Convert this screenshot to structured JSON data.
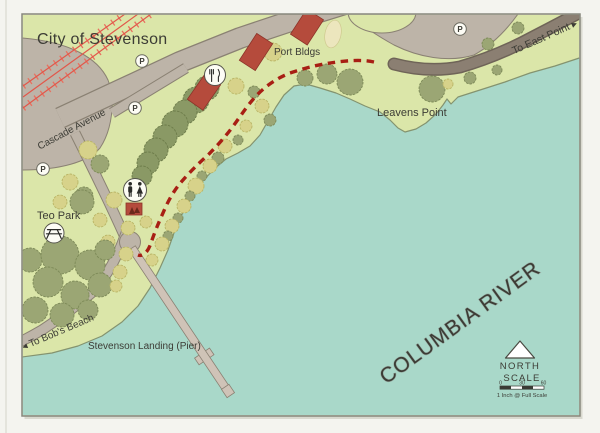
{
  "map_title": "City of Stevenson",
  "labels": {
    "port_bldgs": "Port Bldgs",
    "leavens_point": "Leavens Point",
    "cascade_avenue": "Cascade Avenue",
    "to_east_point": "To East Point ▸",
    "to_bobs_beach": "◂ To Bob's Beach",
    "teo_park": "Teo Park",
    "stevenson_landing": "Stevenson Landing (Pier)",
    "columbia_river": "COLUMBIA RIVER"
  },
  "markers": {
    "parking_letter": "P",
    "icons": [
      "restaurant-icon",
      "restroom-icon",
      "picnic-table-icon"
    ]
  },
  "compass": {
    "north_label": "NORTH"
  },
  "scale_bar": {
    "title": "SCALE",
    "ticks": [
      "0",
      "30",
      "60"
    ],
    "note": "1 Inch @ Full Scale"
  },
  "colors": {
    "land": "#dbe6a9",
    "water": "#a9d8c9",
    "road": "#bdb4a8",
    "road_dark": "#8b7f72",
    "railroad": "#e2574a",
    "building": "#b54b3c",
    "trail": "#a81f14",
    "tree_olive": "#9ba674",
    "shrub_yellow": "#d7d28a",
    "text": "#3c3c35",
    "frame_bg": "#f4f4ef"
  }
}
